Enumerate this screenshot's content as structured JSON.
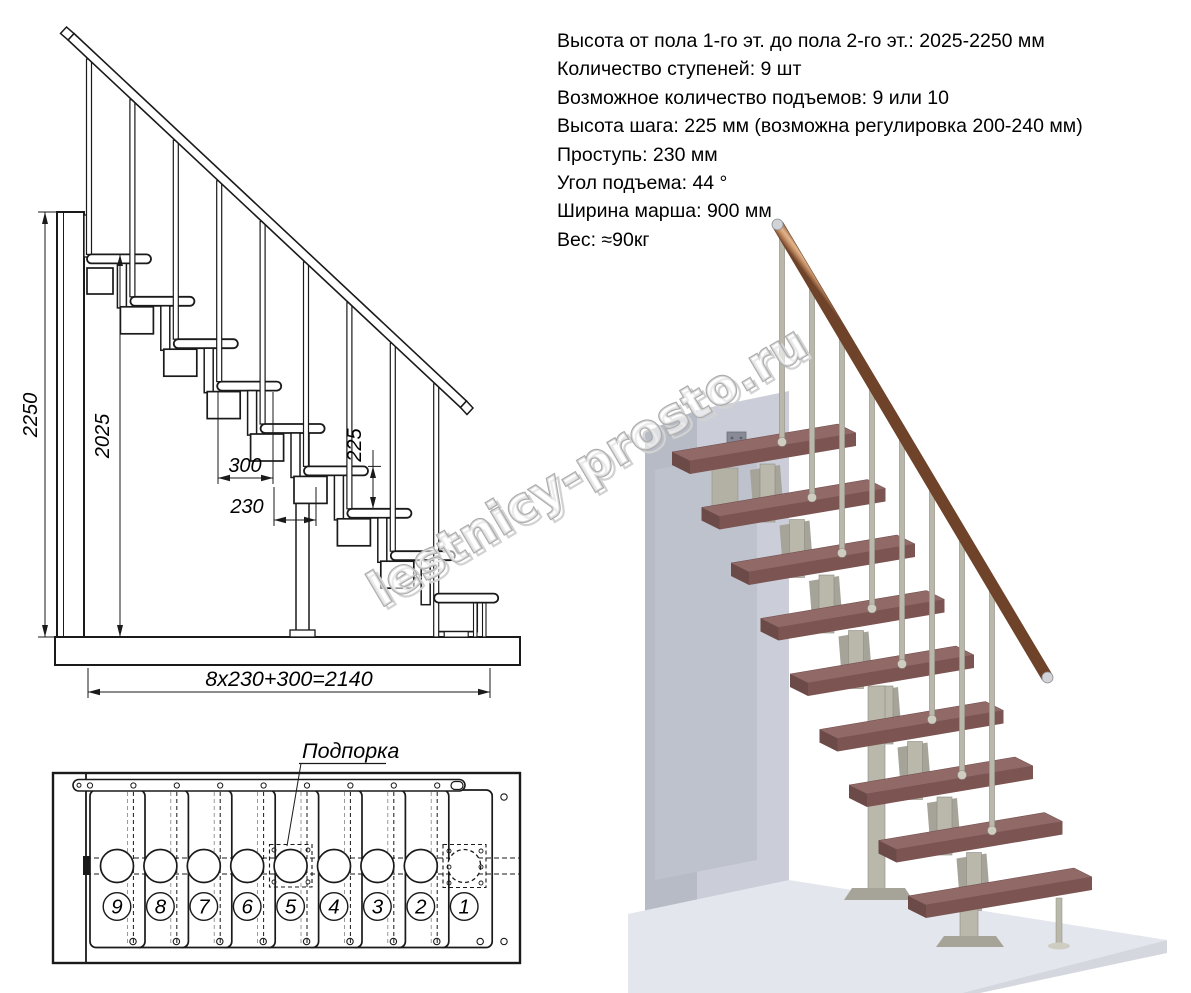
{
  "specs": {
    "lines": [
      "Высота от пола 1-го эт. до пола 2-го эт.: 2025-2250 мм",
      "Количество ступеней: 9 шт",
      "Возможное количество подъемов: 9 или 10",
      "Высота шага: 225 мм (возможна регулировка 200-240 мм)",
      "Проступь: 230 мм",
      "Угол подъема: 44 °",
      "Ширина марша: 900 мм",
      "Вес: ≈90кг"
    ]
  },
  "elevation": {
    "dim_total_height": "2250",
    "dim_upper_height": "2025",
    "dim_tread_depth": "300",
    "dim_step_run": "230",
    "dim_step_rise": "225",
    "dim_total_run": "8x230+300=2140"
  },
  "plan": {
    "support_label": "Подпорка",
    "step_numbers": [
      "9",
      "8",
      "7",
      "6",
      "5",
      "4",
      "3",
      "2",
      "1"
    ]
  },
  "watermark": {
    "text": "lestnicy-prosto.ru"
  },
  "colors": {
    "line": "#1a1a1a",
    "tread_top": "#916967",
    "tread_front": "#7c5452",
    "tread_side": "#6b4a48",
    "metal": "#bab7ab",
    "metal_dark": "#8e8b80",
    "metal_light": "#cfccc1",
    "rail_dark": "#71452c",
    "rail_mid": "#c89268",
    "rail_light": "#e3b58d",
    "wall_front": "#cbced8",
    "wall_side": "#b7bbc5",
    "wall_shadow": "#bec2cc",
    "floor": "#e4e6ed",
    "floor_edge": "#d5d7df",
    "bracket_gray": "#a6a399",
    "watermark": "#ababab"
  }
}
